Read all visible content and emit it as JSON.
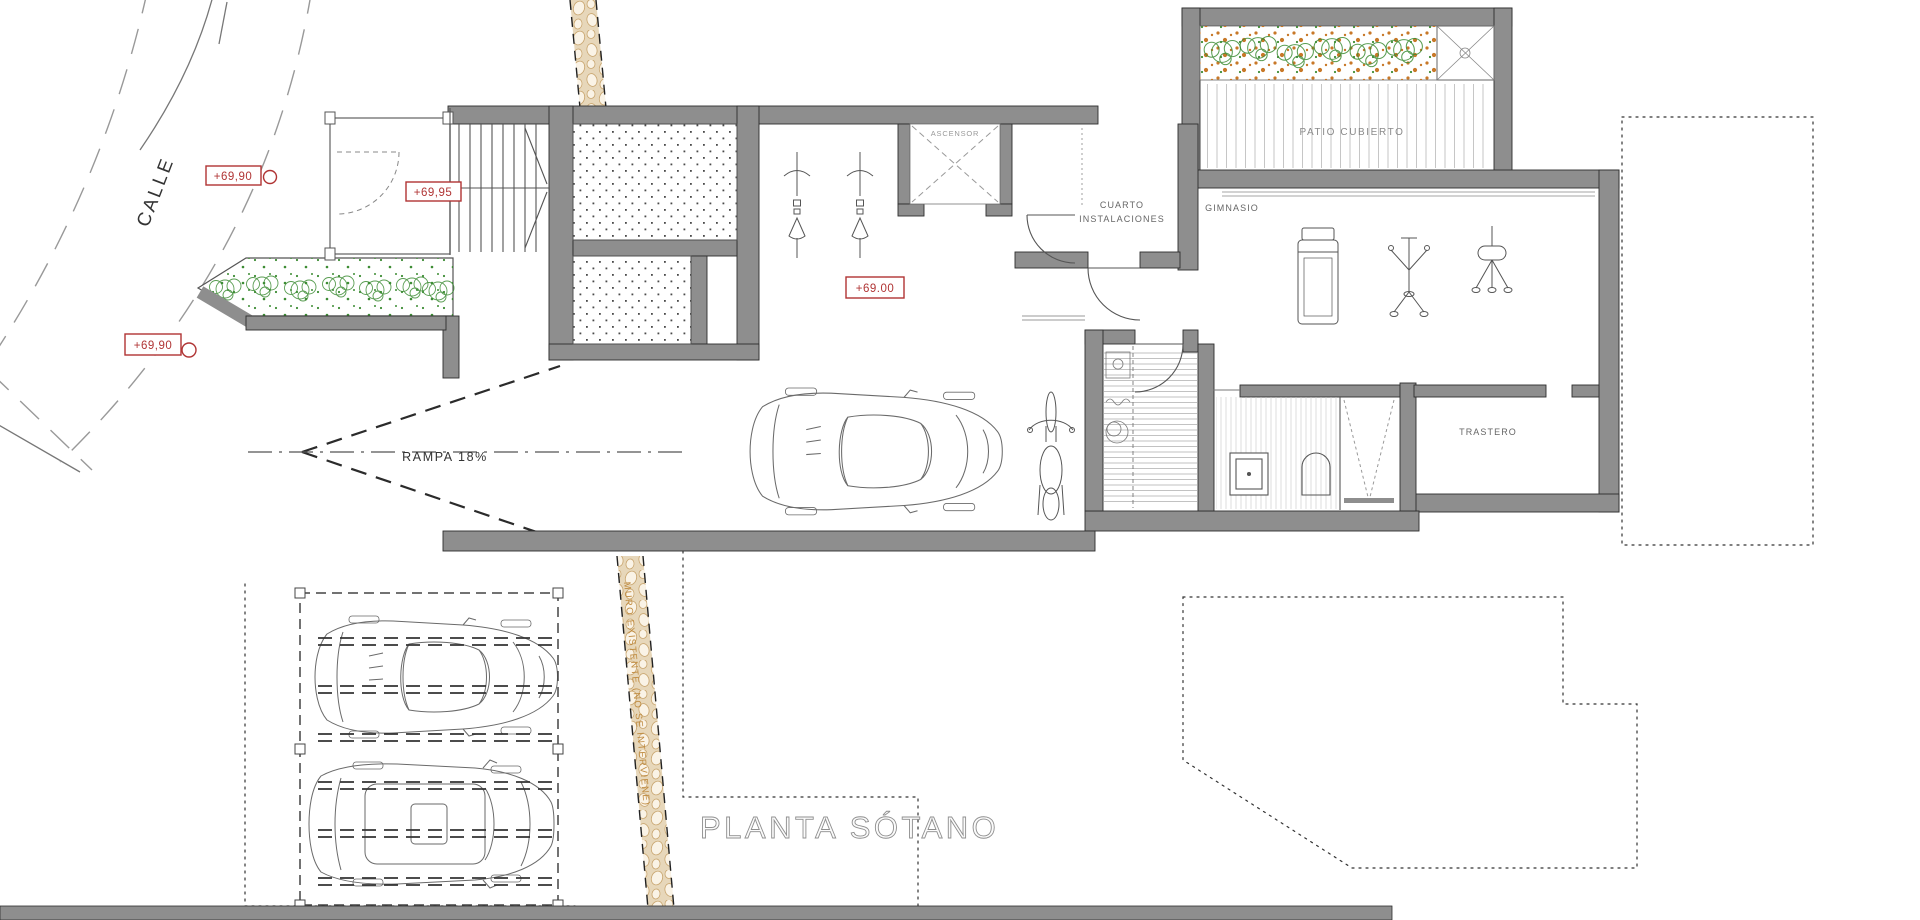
{
  "labels": {
    "title": "PLANTA SÓTANO",
    "street": "CALLE",
    "ramp": "RAMPA  18%",
    "wall_note": "MURO EXISTENTE (NO SE INTERVIENE)",
    "elevator": "ASCENSOR",
    "utility1": "CUARTO",
    "utility2": "INSTALACIONES",
    "gym": "GIMNASIO",
    "patio": "PATIO CUBIERTO",
    "storage": "TRASTERO",
    "lvl_street_a": "+69,90",
    "lvl_entry": "+69,95",
    "lvl_street_b": "+69,90",
    "lvl_garage": "+69.00"
  },
  "colors": {
    "wall_gray": "#8e8e8e",
    "annotation_red": "#b03434",
    "plant_green": "#3d8c34",
    "plant_orange": "#c87828",
    "stone_tan": "#e7d7ba",
    "note_text": "#bf8a3e"
  }
}
